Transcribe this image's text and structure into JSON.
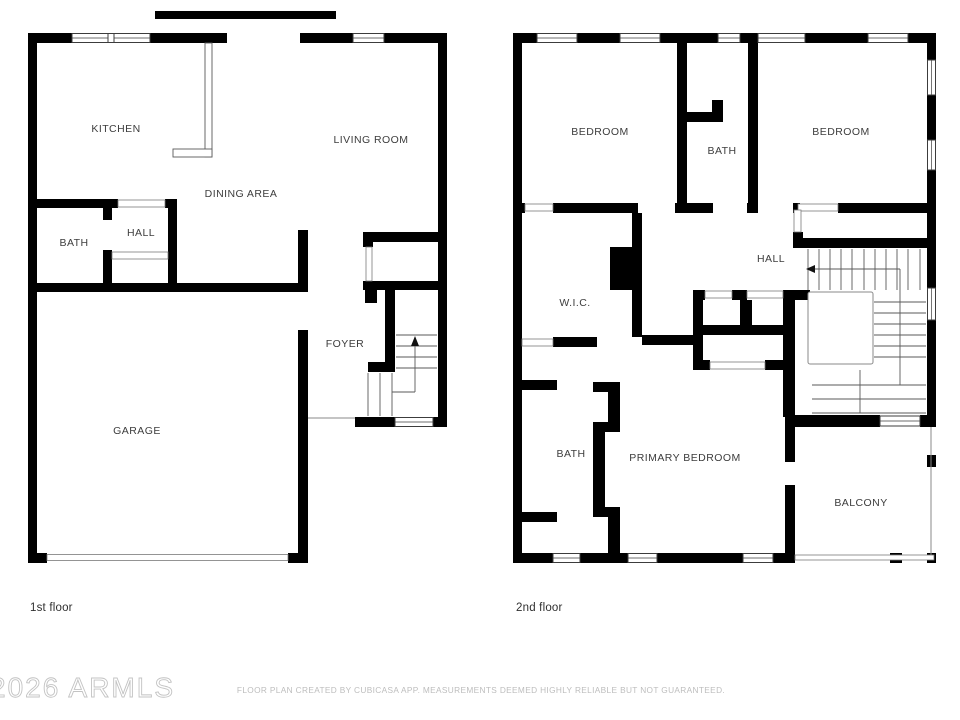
{
  "first_floor": {
    "caption": "1st floor",
    "rooms": {
      "kitchen": "KITCHEN",
      "living_room": "LIVING ROOM",
      "dining_area": "DINING AREA",
      "bath": "BATH",
      "hall": "HALL",
      "foyer": "FOYER",
      "garage": "GARAGE"
    }
  },
  "second_floor": {
    "caption": "2nd floor",
    "rooms": {
      "bedroom_left": "BEDROOM",
      "bath_upper": "BATH",
      "bedroom_right": "BEDROOM",
      "hall": "HALL",
      "wic": "W.I.C.",
      "bath_lower": "BATH",
      "primary_bedroom": "PRIMARY BEDROOM",
      "balcony": "BALCONY"
    }
  },
  "watermark": "2026 ARMLS",
  "footer": "FLOOR PLAN CREATED BY CUBICASA APP. MEASUREMENTS DEEMED HIGHLY RELIABLE BUT NOT GUARANTEED.",
  "colors": {
    "wall": "#000000",
    "label": "#3d3d3d",
    "stair_line": "#5a5a5a",
    "watermark": "#c3c3c3",
    "footer": "#bdbdbd"
  }
}
